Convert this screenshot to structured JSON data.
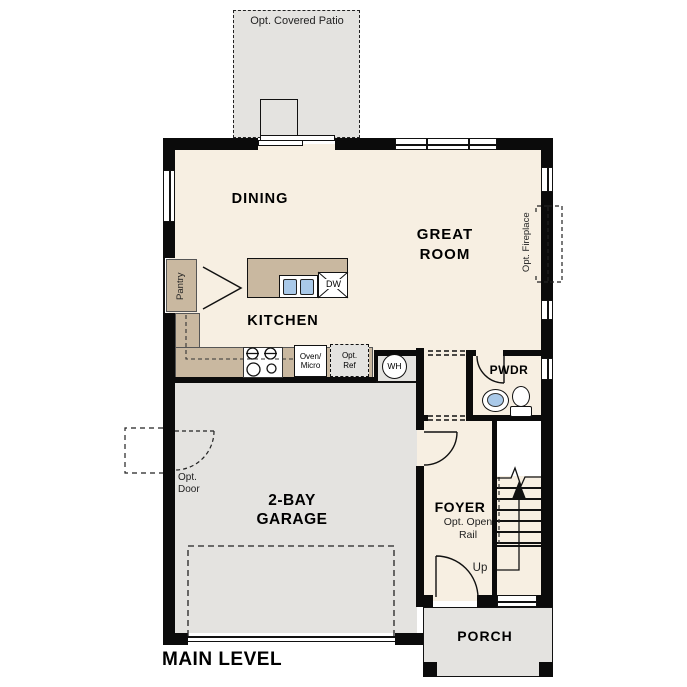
{
  "plan_title": "MAIN LEVEL",
  "colors": {
    "wall": "#0b0b0b",
    "floor": "#f7efe2",
    "garage_floor": "#e4e3e0",
    "counter": "#c9b8a0",
    "sink_blue": "#a9c9e9"
  },
  "rooms": {
    "patio": {
      "label": "Opt. Covered Patio"
    },
    "dining": {
      "label": "DINING"
    },
    "great_room": {
      "line1": "GREAT",
      "line2": "ROOM"
    },
    "kitchen": {
      "label": "KITCHEN"
    },
    "pantry": {
      "label": "Pantry"
    },
    "garage": {
      "line1": "2-BAY",
      "line2": "GARAGE"
    },
    "foyer": {
      "label": "FOYER"
    },
    "pwdr": {
      "label": "PWDR"
    },
    "porch": {
      "label": "PORCH"
    }
  },
  "annotations": {
    "opt_fireplace": "Opt. Fireplace",
    "opt_door": {
      "line1": "Opt.",
      "line2": "Door"
    },
    "opt_open_rail": {
      "line1": "Opt. Open",
      "line2": "Rail"
    },
    "up": "Up",
    "water_heater": "WH",
    "dishwasher": "DW",
    "oven_micro": {
      "line1": "Oven/",
      "line2": "Micro"
    },
    "opt_ref": {
      "line1": "Opt.",
      "line2": "Ref"
    }
  }
}
